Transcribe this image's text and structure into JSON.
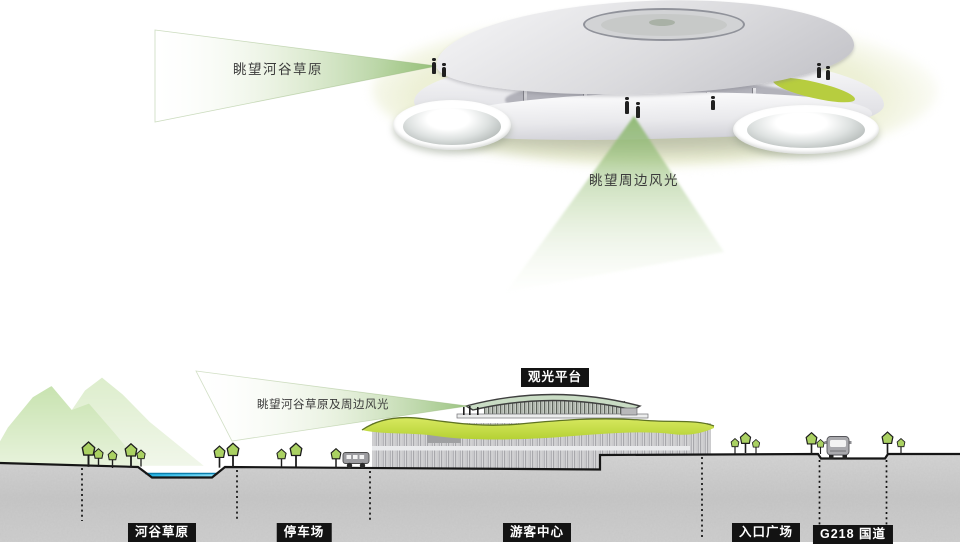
{
  "top_view": {
    "label_view_valley": "眺望河谷草原",
    "label_view_surroundings": "眺望周边风光"
  },
  "section": {
    "label_view_cone": "眺望河谷草原及周边风光",
    "platform_label": "观光平台",
    "zones": [
      {
        "label": "河谷草原"
      },
      {
        "label": "停车场"
      },
      {
        "label": "游客中心"
      },
      {
        "label": "入口广场"
      },
      {
        "label": "G218 国道"
      }
    ]
  },
  "colors": {
    "view_cone_green": "#8fbc72",
    "ambient_glow": "#e9edcd",
    "wavy_roof_yellow_green": "#c6dd45",
    "tree_green": "#aad162",
    "water_blue": "#2ab6e8",
    "ground_grey": "#c9c9c9",
    "label_bg": "#131313",
    "label_text": "#ffffff"
  }
}
